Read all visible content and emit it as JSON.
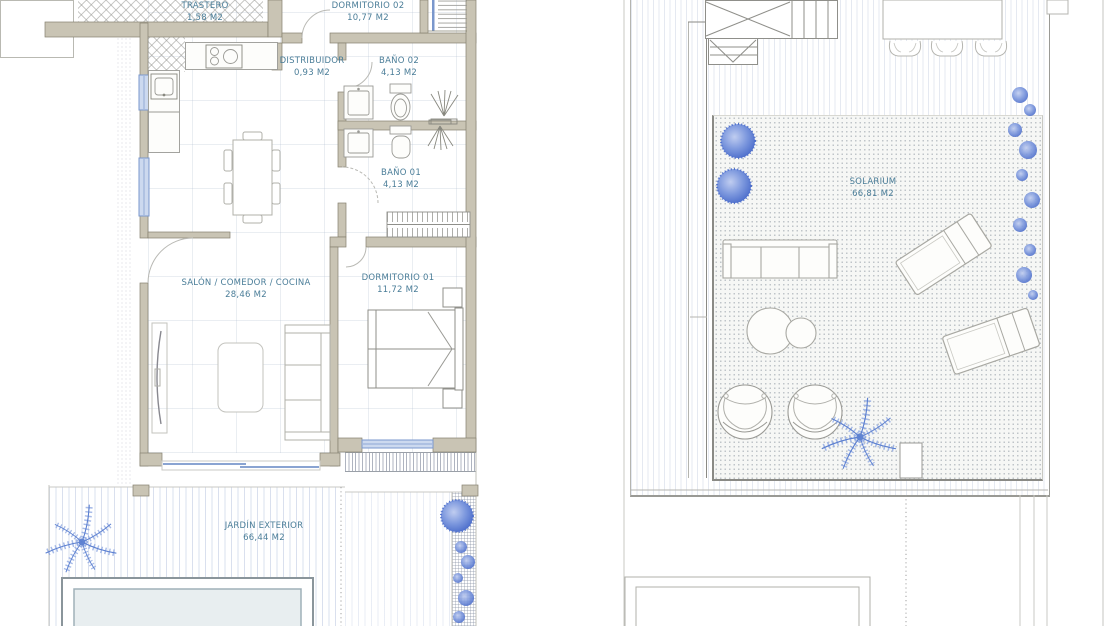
{
  "document": {
    "type": "architectural floor plans, two storeys side by side",
    "left_plan_title": "ground floor",
    "right_plan_title": "roof / solarium floor"
  },
  "plan_left": {
    "rooms": {
      "trastero": {
        "name": "TRASTERO",
        "area": "1,58 M2"
      },
      "dormitorio_02": {
        "name": "DORMITORIO 02",
        "area": "10,77 M2"
      },
      "distribuidor": {
        "name": "DISTRIBUIDOR",
        "area": "0,93 M2"
      },
      "bano_02": {
        "name": "BAÑO 02",
        "area": "4,13 M2"
      },
      "bano_01": {
        "name": "BAÑO 01",
        "area": "4,13 M2"
      },
      "salon_comedor_cocina": {
        "name": "SALÓN / COMEDOR / COCINA",
        "area": "28,46 M2"
      },
      "dormitorio_01": {
        "name": "DORMITORIO 01",
        "area": "11,72 M2"
      },
      "jardin_exterior": {
        "name": "JARDÍN EXTERIOR",
        "area": "66,44 M2"
      }
    }
  },
  "plan_right": {
    "rooms": {
      "solarium": {
        "name": "SOLARIUM",
        "area": "66,81 M2"
      }
    }
  },
  "symbols": {
    "cooktop-icon": "4-burner hob",
    "kitchen-sink-icon": "kitchen sink",
    "bathroom-sink-icon": "washbasin",
    "toilet-icon": "toilet",
    "shower-icon": "shower rays with tray",
    "staircase-icon": "staircase with treads",
    "wardrobe-icon": "wardrobe with hangers",
    "double-bed-icon": "double bed with nightstands",
    "sofa-icon": "three-seat sofa",
    "dining-table-icon": "dining table with six chairs",
    "tv-unit-icon": "TV unit",
    "coffee-table-icon": "coffee table",
    "pool-icon": "swimming pool",
    "palm-plant-icon": "palm plant",
    "bush-icon": "round bush",
    "sun-lounger-icon": "sun lounger",
    "egg-chair-icon": "round garden chair",
    "outdoor-sofa-icon": "outdoor sofa",
    "round-table-icon": "round side tables",
    "patio-table-icon": "outdoor table with chairs",
    "climbing-plant-icon": "climbing plants"
  },
  "colors": {
    "wall_fill": "#c9c4b4",
    "wall_outline": "#85816f",
    "label_text": "#4a7d98",
    "window_blue": "#7a97cc",
    "plant_blue": "#5b7fd0",
    "pool_fill": "#e8eef0",
    "paper": "#ffffff"
  }
}
